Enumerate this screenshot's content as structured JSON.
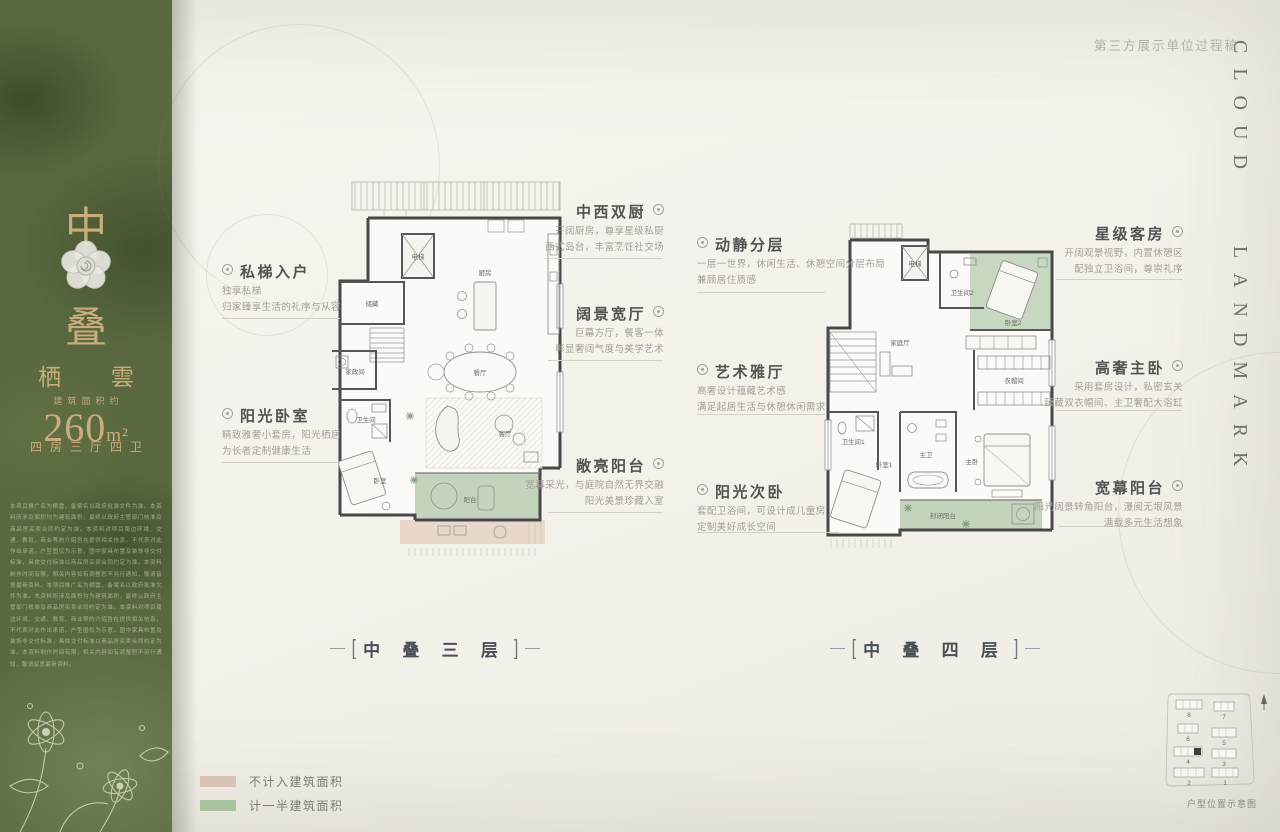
{
  "header": {
    "draft_note": "第三方展示单位过程稿",
    "brand": "CLOUD LANDMARK"
  },
  "sidebar": {
    "unit_char_top": "中",
    "unit_char_bottom": "叠",
    "series_name": "栖 雲",
    "area_label": "建筑面积约",
    "area_value": "260",
    "area_unit": "m²",
    "layout_desc": "四房三厅四卫",
    "disclaimer": "本项目推广名为栖雲，备案名以政府批准文件为准。本资料所涉及面积均为建筑面积，最终以政府主管部门核准及商品房买卖合同约定为准。本资料对项目周边环境、交通、教育、商业等的介绍旨在提供相关信息，不代表对此作出承诺。户型图仅为示意，图中家具布置及装饰非交付标准，具体交付标准以商品房买卖合同约定为准。本资料制作时间有限，相关内容如有调整恕不另行通知，敬请留意最新资料。本项目推广名为栖雲，备案名以政府批准文件为准。本资料所涉及面积均为建筑面积，最终以政府主管部门核准及商品房买卖合同约定为准。本资料对项目周边环境、交通、教育、商业等的介绍旨在提供相关信息，不代表对此作出承诺。户型图仅为示意，图中家具布置及装饰非交付标准，具体交付标准以商品房买卖合同约定为准。本资料制作时间有限，相关内容如有调整恕不另行通知，敬请留意最新资料。"
  },
  "decor": {
    "bracket_left": "[",
    "bracket_right": "]"
  },
  "plan3": {
    "title": "中 叠 三 层",
    "rooms": {
      "equipment": "设备平台",
      "elevator": "电梯",
      "storage": "储藏",
      "kitchen": "厨房",
      "dining": "餐厅",
      "housework": "家政间",
      "bathroom": "卫生间",
      "bedroom": "卧室",
      "living": "客厅",
      "balcony": "阳台"
    },
    "annotations": [
      {
        "title": "中西双厨",
        "lines": [
          "开阔厨房，尊享星级私厨",
          "西式岛台，丰富烹饪社交场"
        ]
      },
      {
        "title": "私梯入户",
        "lines": [
          "独享私梯",
          "归家臻享生活的礼序与从容"
        ]
      },
      {
        "title": "阔景宽厅",
        "lines": [
          "巨幕方厅，餐客一体",
          "彰显奢阔气度与美学艺术"
        ]
      },
      {
        "title": "阳光卧室",
        "lines": [
          "精致雅奢小套房，阳光栖居",
          "为长者定制健康生活"
        ]
      },
      {
        "title": "敞亮阳台",
        "lines": [
          "宽幕采光，与庭院自然无界交融",
          "阳光美景珍藏入室"
        ]
      }
    ]
  },
  "plan4": {
    "title": "中 叠 四 层",
    "rooms": {
      "elevator": "电梯",
      "bathroom2": "卫生间2",
      "bedroom2": "卧室2",
      "family": "家庭厅",
      "cloakroom": "衣帽间",
      "bathroom1": "卫生间1",
      "bedroom1": "卧室1",
      "master_bath": "主卫",
      "master_bedroom": "主卧",
      "enclosed_balcony": "封闭阳台"
    },
    "annotations": [
      {
        "title": "动静分层",
        "lines": [
          "一层一世界，休闲生活、休憩空间分层布局",
          "兼顾居住质感"
        ]
      },
      {
        "title": "星级客房",
        "lines": [
          "开阔观景视野，内置休憩区",
          "配独立卫浴间，尊崇礼序"
        ]
      },
      {
        "title": "艺术雅厅",
        "lines": [
          "高奢设计蕴藏艺术感",
          "满足起居生活与休憩休闲需求"
        ]
      },
      {
        "title": "高奢主卧",
        "lines": [
          "采用套房设计，私密玄关",
          "臻藏双衣帽间、主卫奢配大浴缸"
        ]
      },
      {
        "title": "阳光次卧",
        "lines": [
          "套配卫浴间，可设计成儿童房",
          "定制美好成长空间"
        ]
      },
      {
        "title": "宽幕阳台",
        "lines": [
          "阳光阔景转角阳台，漫阅无垠风景",
          "满载多元生活想象"
        ]
      }
    ]
  },
  "legend": {
    "items": [
      {
        "label": "不计入建筑面积",
        "color": "#d9c3b2"
      },
      {
        "label": "计一半建筑面积",
        "color": "#a9c3a0"
      }
    ]
  },
  "site_map": {
    "caption": "户型位置示意图",
    "buildings": [
      "8",
      "7",
      "6",
      "5",
      "4",
      "3",
      "2",
      "1"
    ]
  }
}
